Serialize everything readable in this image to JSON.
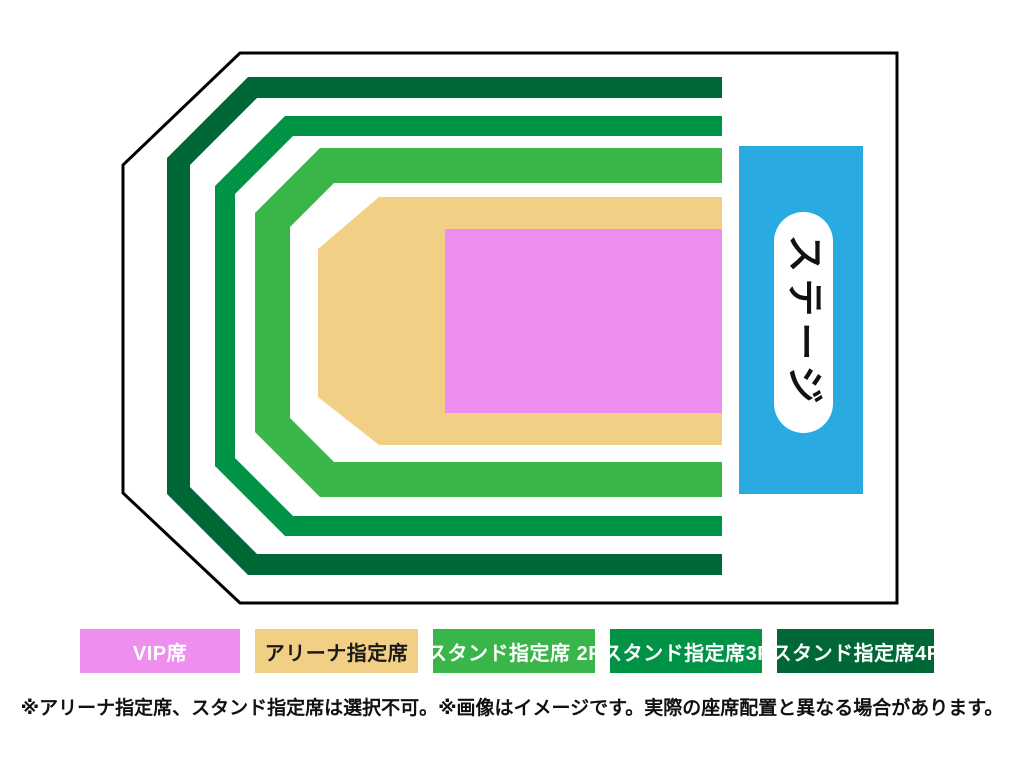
{
  "map": {
    "stage_label": "ステージ",
    "stage_color": "#29abe2",
    "outline_color": "#000000",
    "background_color": "#ffffff"
  },
  "legend": {
    "items": [
      {
        "id": "vip",
        "label": "VIP席",
        "color": "#ee8ff0",
        "text_color": "#ffffff"
      },
      {
        "id": "arena",
        "label": "アリーナ指定席",
        "color": "#f1cf85",
        "text_color": "#1a1a1a"
      },
      {
        "id": "stand-2f",
        "label": "スタンド指定席 2F",
        "color": "#39b54a",
        "text_color": "#ffffff"
      },
      {
        "id": "stand-3f",
        "label": "スタンド指定席3F",
        "color": "#009245",
        "text_color": "#ffffff"
      },
      {
        "id": "stand-4f",
        "label": "スタンド指定席4F",
        "color": "#006837",
        "text_color": "#ffffff"
      }
    ]
  },
  "footer": {
    "note": "※アリーナ指定席、スタンド指定席は選択不可。※画像はイメージです。実際の座席配置と異なる場合があります。"
  }
}
